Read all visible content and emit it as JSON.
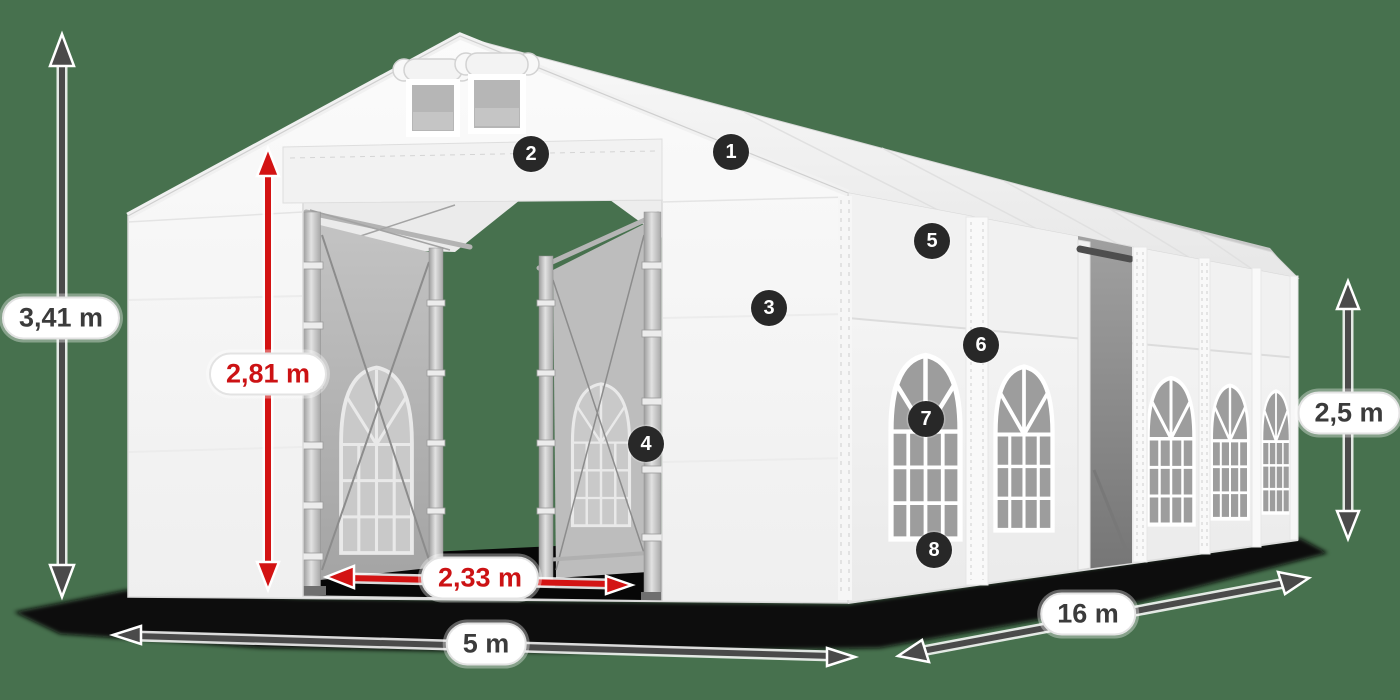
{
  "diagram": {
    "subject": "party-tent-with-dimensions"
  },
  "dimensions": {
    "total_height": {
      "value": "3,41 m",
      "color": "dark"
    },
    "entrance_height": {
      "value": "2,81 m",
      "color": "red"
    },
    "entrance_width": {
      "value": "2,33 m",
      "color": "red"
    },
    "front_width": {
      "value": "5 m",
      "color": "dark"
    },
    "side_length": {
      "value": "16 m",
      "color": "dark"
    },
    "side_wall_height": {
      "value": "2,5 m",
      "color": "dark"
    }
  },
  "markers": [
    {
      "number": "1"
    },
    {
      "number": "2"
    },
    {
      "number": "3"
    },
    {
      "number": "4"
    },
    {
      "number": "5"
    },
    {
      "number": "6"
    },
    {
      "number": "7"
    },
    {
      "number": "8"
    }
  ],
  "colors": {
    "background": "#47714e",
    "arrow_dark": "#4a4a4a",
    "arrow_red": "#d31313",
    "marker_bg": "#282828",
    "label_text_dark": "#3b3b3b",
    "label_text_red": "#cc1214",
    "tent_fabric": "#f7f7f7",
    "window_glass": "#9d9d9d",
    "ground_shadow": "#070707"
  }
}
